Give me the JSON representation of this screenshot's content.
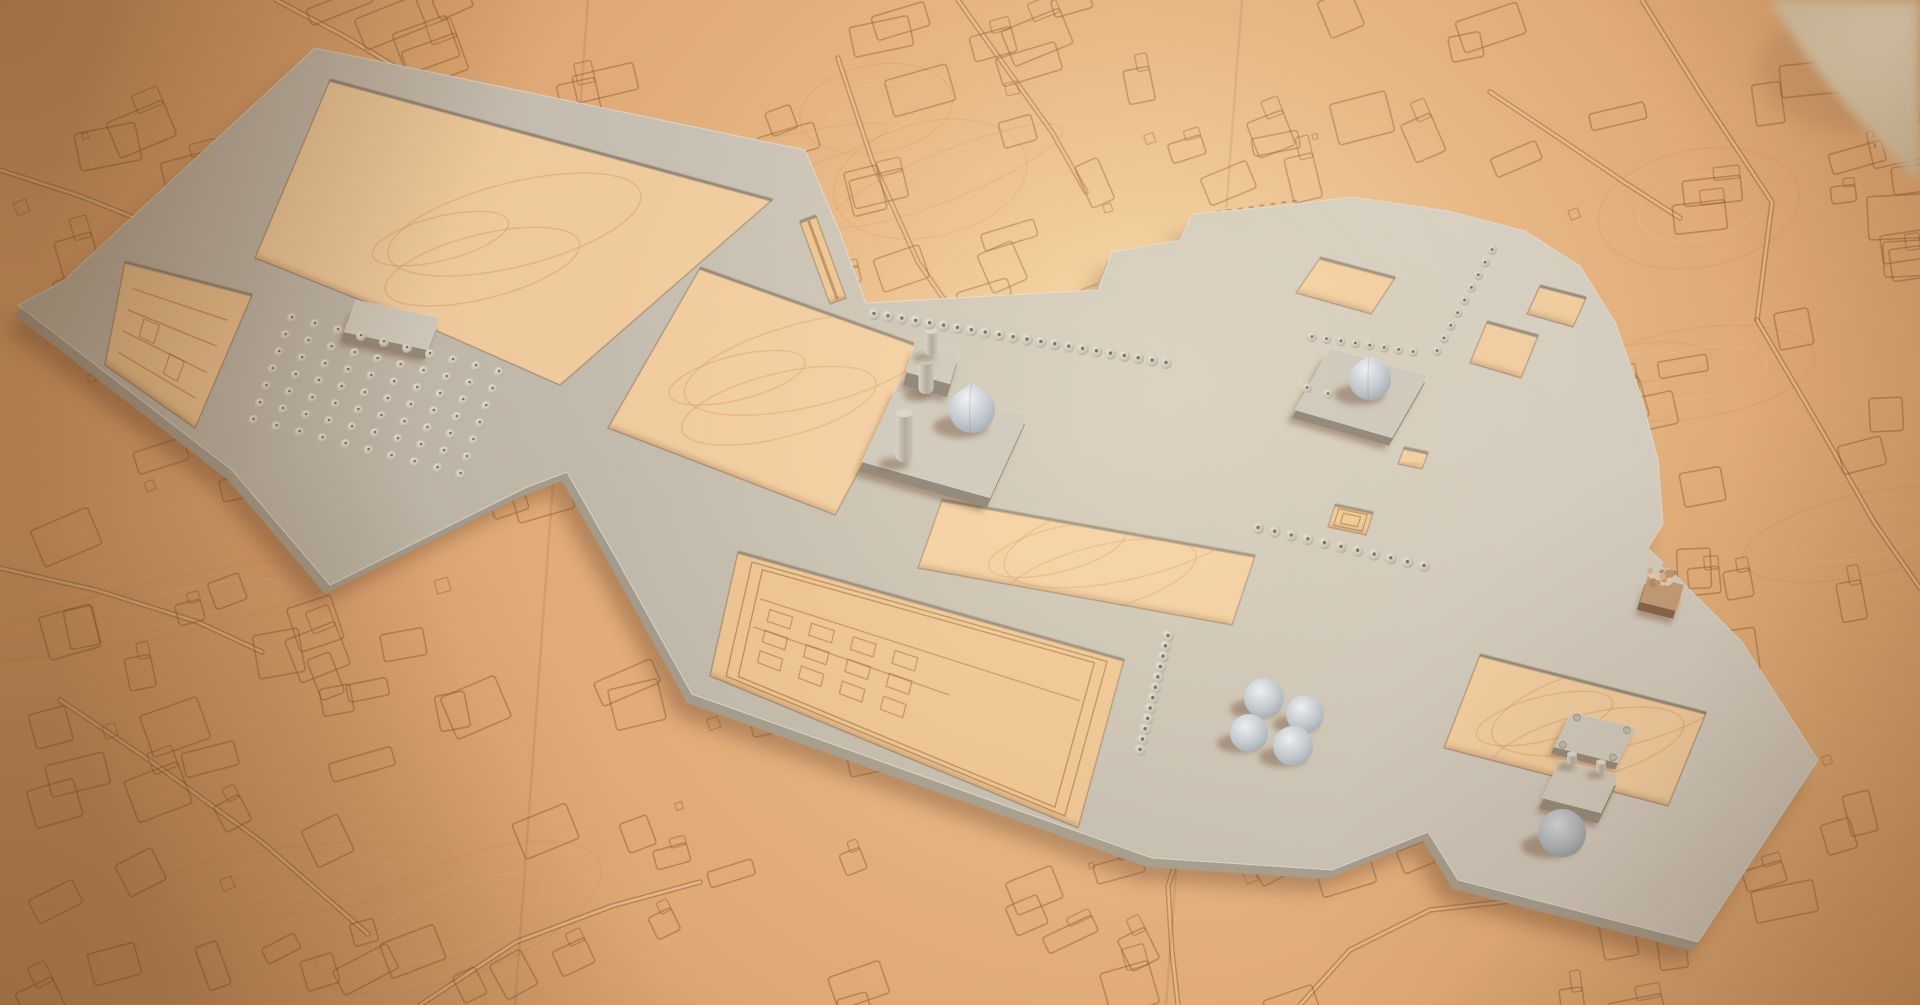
{
  "scene": {
    "description": "3D render of a plaster architectural massing model of a historic mosque-and-bazaar complex placed on a laser-etched wooden city-map base, warm studio lighting, blurred paper roll in top-right corner",
    "palette": {
      "wood_base": "#e2a974",
      "wood_mid": "#ecbd8b",
      "wood_hole": "#f5d0a2",
      "wood_hole_etched": "#f0c794",
      "etch": "#8f5a2d",
      "road_light": "#ecbd8b",
      "model_top_light": "#d8d2c6",
      "model_top_dark": "#bfb8aa",
      "model_top_fill": "#cdc6ba",
      "model_side": "#a89f90",
      "model_side_dark": "#968c7d",
      "plinth_top": "#d3cdc0",
      "shadow": "rgba(104,62,34,0.38)",
      "edge_light": "#eae5da",
      "dome_hi": "#f1f4f6",
      "dome_mid": "#c6ccd1",
      "dome_lo": "#99a1a9",
      "dome_dark_hi": "#d6dadd",
      "dome_dark_mid": "#b0b6bb",
      "dome_dark_lo": "#868d94",
      "bump_hi": "#e9e4d9",
      "bump_mid": "#cfc8ba",
      "bump_lo": "#a89e8f",
      "bump_dot": "#7e7465",
      "cyl_a": "#dcd6ca",
      "cyl_b": "#b6ad9e",
      "cyl_c": "#cac3b5",
      "tree_top": "#c7a07b",
      "tree_side": "#8a6648",
      "canopy": [
        "#dcb897",
        "#c69b78",
        "#ead0b0",
        "#b88f6d"
      ],
      "bg_obj_a": "#eee0c4",
      "bg_obj_b": "#c6b18e",
      "vignette": "#5a3414"
    },
    "base": {
      "w": 1920,
      "h": 1005,
      "glow_center": [
        1150,
        400
      ],
      "glow_radius": 900,
      "hotspot_center": [
        1160,
        400
      ],
      "hotspot_radius": 560,
      "seams": [
        [
          [
            588,
            0
          ],
          [
            515,
            1005
          ]
        ],
        [
          [
            1242,
            0
          ],
          [
            1166,
            1005
          ]
        ]
      ]
    },
    "map": {
      "seed": 7,
      "block_count": 215,
      "tiny_count": 34,
      "grain_count": 16,
      "roads": [
        [
          [
            838,
            58
          ],
          [
            872,
            160
          ],
          [
            918,
            262
          ],
          [
            946,
            302
          ]
        ],
        [
          [
            1642,
            0
          ],
          [
            1702,
            96
          ],
          [
            1772,
            202
          ],
          [
            1757,
            320
          ]
        ],
        [
          [
            1757,
            320
          ],
          [
            1818,
            424
          ],
          [
            1874,
            522
          ],
          [
            1920,
            588
          ]
        ],
        [
          [
            1186,
            832
          ],
          [
            1168,
            886
          ],
          [
            1172,
            952
          ],
          [
            1178,
            1005
          ]
        ],
        [
          [
            420,
            1005
          ],
          [
            516,
            942
          ],
          [
            612,
            906
          ],
          [
            700,
            882
          ]
        ],
        [
          [
            0,
            568
          ],
          [
            96,
            590
          ],
          [
            198,
            622
          ],
          [
            262,
            652
          ]
        ],
        [
          [
            958,
            0
          ],
          [
            1002,
            62
          ],
          [
            1052,
            132
          ],
          [
            1086,
            192
          ]
        ],
        [
          [
            276,
            0
          ],
          [
            344,
            36
          ],
          [
            428,
            86
          ],
          [
            468,
            118
          ]
        ],
        [
          [
            60,
            700
          ],
          [
            152,
            762
          ],
          [
            262,
            842
          ],
          [
            368,
            934
          ]
        ],
        [
          [
            1490,
            92
          ],
          [
            1562,
            140
          ],
          [
            1624,
            182
          ],
          [
            1680,
            218
          ]
        ],
        [
          [
            1300,
            1005
          ],
          [
            1350,
            950
          ],
          [
            1430,
            910
          ],
          [
            1520,
            900
          ]
        ],
        [
          [
            0,
            170
          ],
          [
            80,
            196
          ],
          [
            170,
            232
          ]
        ]
      ],
      "dashed": [
        [
          [
            1862,
            56
          ],
          [
            1876,
            152
          ]
        ],
        [
          [
            1216,
            212
          ],
          [
            1300,
            200
          ]
        ],
        [
          [
            1136,
            772
          ],
          [
            1210,
            792
          ]
        ]
      ]
    },
    "model": {
      "outer": [
        [
          315,
          48
        ],
        [
          805,
          150
        ],
        [
          840,
          233
        ],
        [
          866,
          303
        ],
        [
          1098,
          290
        ],
        [
          1112,
          252
        ],
        [
          1180,
          240
        ],
        [
          1192,
          214
        ],
        [
          1270,
          207
        ],
        [
          1352,
          197
        ],
        [
          1448,
          211
        ],
        [
          1525,
          231
        ],
        [
          1580,
          266
        ],
        [
          1615,
          322
        ],
        [
          1640,
          392
        ],
        [
          1658,
          460
        ],
        [
          1663,
          524
        ],
        [
          1648,
          548
        ],
        [
          1742,
          642
        ],
        [
          1818,
          760
        ],
        [
          1698,
          942
        ],
        [
          1458,
          880
        ],
        [
          1428,
          832
        ],
        [
          1332,
          870
        ],
        [
          1152,
          858
        ],
        [
          692,
          694
        ],
        [
          620,
          565
        ],
        [
          567,
          472
        ],
        [
          525,
          488
        ],
        [
          330,
          585
        ],
        [
          232,
          470
        ],
        [
          18,
          305
        ],
        [
          62,
          282
        ]
      ],
      "holes": [
        {
          "name": "enclosure-courtyard",
          "type": "clean",
          "pts": [
            [
              330,
              80
            ],
            [
              772,
              200
            ],
            [
              560,
              385
            ],
            [
              435,
              330
            ],
            [
              255,
              258
            ]
          ]
        },
        {
          "name": "terraced-garden",
          "type": "terraced",
          "pts": [
            [
              125,
              262
            ],
            [
              252,
              295
            ],
            [
              195,
              428
            ],
            [
              105,
              365
            ]
          ]
        },
        {
          "name": "main-courtyard",
          "type": "clean",
          "pts": [
            [
              700,
              268
            ],
            [
              925,
              348
            ],
            [
              835,
              515
            ],
            [
              608,
              428
            ]
          ]
        },
        {
          "name": "east-courtyard",
          "type": "clean",
          "pts": [
            [
              942,
              500
            ],
            [
              1255,
              556
            ],
            [
              1232,
              625
            ],
            [
              918,
              568
            ]
          ]
        },
        {
          "name": "courtyard-a",
          "type": "clean",
          "pts": [
            [
              1320,
              258
            ],
            [
              1395,
              278
            ],
            [
              1371,
              314
            ],
            [
              1296,
              293
            ]
          ]
        },
        {
          "name": "courtyard-b",
          "type": "clean",
          "pts": [
            [
              1487,
              322
            ],
            [
              1538,
              336
            ],
            [
              1521,
              378
            ],
            [
              1470,
              363
            ]
          ]
        },
        {
          "name": "courtyard-c",
          "type": "clean",
          "pts": [
            [
              1540,
              286
            ],
            [
              1586,
              298
            ],
            [
              1573,
              327
            ],
            [
              1527,
              314
            ]
          ]
        },
        {
          "name": "shrine-cutout",
          "type": "concentric",
          "pts": [
            [
              1335,
              505
            ],
            [
              1373,
              513
            ],
            [
              1366,
              535
            ],
            [
              1328,
              527
            ]
          ]
        },
        {
          "name": "small-cutout",
          "type": "clean",
          "pts": [
            [
              1404,
              448
            ],
            [
              1428,
              453
            ],
            [
              1422,
              469
            ],
            [
              1398,
              464
            ]
          ]
        },
        {
          "name": "archaeological-garden",
          "type": "garden",
          "pts": [
            [
              738,
              552
            ],
            [
              1124,
              660
            ],
            [
              1078,
              828
            ],
            [
              710,
              676
            ]
          ]
        },
        {
          "name": "gate-courtyard",
          "type": "clean",
          "pts": [
            [
              1480,
              655
            ],
            [
              1706,
              713
            ],
            [
              1668,
              806
            ],
            [
              1444,
              748
            ]
          ]
        },
        {
          "name": "road-gap",
          "type": "road",
          "pts": [
            [
              800,
              222
            ],
            [
              816,
              216
            ],
            [
              846,
              298
            ],
            [
              830,
              304
            ]
          ]
        }
      ],
      "plinths": [
        {
          "name": "dome-plinth-west",
          "pts": [
            [
              900,
              380
            ],
            [
              1028,
              415
            ],
            [
              990,
              498
            ],
            [
              862,
              462
            ]
          ],
          "h": 14
        },
        {
          "name": "dome-plinth-east",
          "pts": [
            [
              1330,
              348
            ],
            [
              1428,
              375
            ],
            [
              1392,
              438
            ],
            [
              1295,
              410
            ]
          ],
          "h": 12
        }
      ],
      "blocks": [
        {
          "name": "platform-hall",
          "pts": [
            [
              356,
              300
            ],
            [
              440,
              318
            ],
            [
              428,
              350
            ],
            [
              344,
              332
            ]
          ],
          "h": 14
        },
        {
          "name": "minaret-block",
          "pts": [
            [
              916,
              338
            ],
            [
              960,
              350
            ],
            [
              950,
              384
            ],
            [
              906,
              372
            ]
          ],
          "h": 20
        },
        {
          "name": "gate-pavilion",
          "pts": [
            [
              1572,
              712
            ],
            [
              1636,
              728
            ],
            [
              1618,
              763
            ],
            [
              1554,
              747
            ]
          ],
          "h": 10,
          "posts": true
        },
        {
          "name": "twin-pavilion",
          "pts": [
            [
              1560,
              760
            ],
            [
              1619,
              775
            ],
            [
              1601,
              813
            ],
            [
              1542,
              798
            ]
          ],
          "h": 16
        }
      ],
      "minarets": [
        {
          "name": "minaret-north",
          "cx": 926,
          "top": 360,
          "w": 15,
          "h": 34
        },
        {
          "name": "minaret-south",
          "cx": 904,
          "top": 412,
          "w": 17,
          "h": 50
        },
        {
          "name": "block-cylinder",
          "cx": 931,
          "top": 330,
          "w": 12,
          "h": 26
        },
        {
          "name": "pavilion-cylinder-a",
          "cx": 1572,
          "top": 753,
          "w": 10,
          "h": 12
        },
        {
          "name": "pavilion-cylinder-b",
          "cx": 1601,
          "top": 761,
          "w": 10,
          "h": 12
        }
      ],
      "domes": [
        {
          "name": "onion-dome-west",
          "cx": 972,
          "cy": 414,
          "r": 23,
          "style": "onion",
          "shade": "light"
        },
        {
          "name": "onion-dome-east",
          "cx": 1370,
          "cy": 383,
          "r": 21,
          "style": "onion",
          "shade": "light"
        },
        {
          "name": "cluster-dome-n",
          "cx": 1264,
          "cy": 698,
          "r": 20,
          "style": "hemi",
          "shade": "light"
        },
        {
          "name": "cluster-dome-e",
          "cx": 1305,
          "cy": 714,
          "r": 19,
          "style": "hemi",
          "shade": "light"
        },
        {
          "name": "cluster-dome-w",
          "cx": 1249,
          "cy": 733,
          "r": 19,
          "style": "hemi",
          "shade": "light"
        },
        {
          "name": "cluster-dome-s",
          "cx": 1293,
          "cy": 746,
          "r": 20,
          "style": "hemi",
          "shade": "light"
        },
        {
          "name": "dome-south",
          "cx": 1562,
          "cy": 833,
          "r": 24,
          "style": "hemi",
          "shade": "dark"
        }
      ],
      "colonnades": [
        {
          "name": "north-colonnade",
          "from": [
            874,
            314
          ],
          "to": [
            1166,
            363
          ],
          "count": 22,
          "r": 6
        },
        {
          "name": "east-colonnade-h",
          "from": [
            1312,
            337
          ],
          "to": [
            1413,
            352
          ],
          "count": 8,
          "r": 5
        },
        {
          "name": "east-colonnade-diag",
          "from": [
            1437,
            351
          ],
          "to": [
            1492,
            250
          ],
          "count": 9,
          "r": 5
        },
        {
          "name": "east-colonnade-pair",
          "from": [
            1307,
            388
          ],
          "to": [
            1328,
            394
          ],
          "count": 2,
          "r": 5
        },
        {
          "name": "mid-colonnade",
          "from": [
            1258,
            528
          ],
          "to": [
            1424,
            566
          ],
          "count": 11,
          "r": 6
        },
        {
          "name": "south-colonnade",
          "from": [
            1168,
            636
          ],
          "to": [
            1140,
            750
          ],
          "count": 12,
          "r": 6
        }
      ],
      "bump_grid": {
        "name": "tomb-field",
        "origin": [
          292,
          318
        ],
        "cols": 10,
        "rows": 7,
        "col_step": [
          23,
          6
        ],
        "row_step": [
          -6.4,
          17
        ],
        "r": 5
      },
      "tree": {
        "name": "tree-block",
        "cube": [
          [
            1648,
            576
          ],
          [
            1684,
            585
          ],
          [
            1676,
            611
          ],
          [
            1640,
            602
          ]
        ],
        "h": 13,
        "canopy_c": [
          1662,
          579
        ],
        "canopy_r": 15,
        "n": 26
      }
    },
    "background_object": {
      "name": "blurred-paper-roll",
      "path": "M 1770,0 L 1920,0 L 1920,182 C 1858,124 1806,64 1770,0 Z"
    }
  }
}
